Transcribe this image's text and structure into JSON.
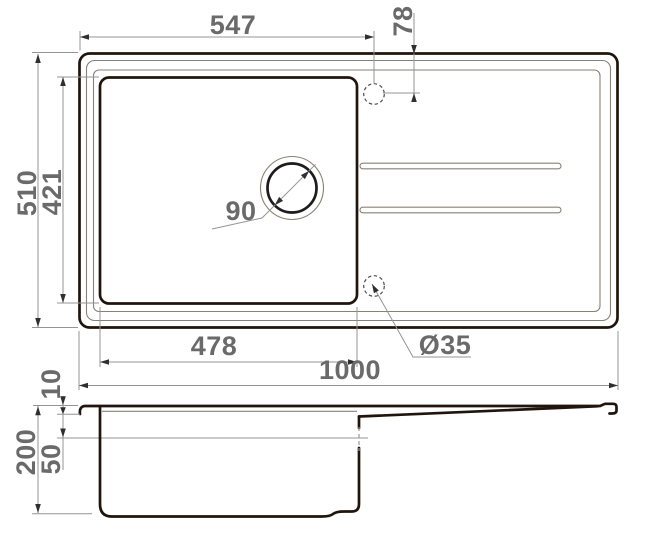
{
  "drawing": {
    "type": "technical-dimension-drawing",
    "subject": "kitchen sink with bowl and drainboard, plan view and section view",
    "units_implied": "mm",
    "dims": {
      "top_width": "547",
      "faucet_offset": "78",
      "overall_depth": "510",
      "bowl_depth": "421",
      "drain_diameter": "90",
      "bowl_width": "478",
      "faucet_hole_diameter": "Ø35",
      "overall_width": "1000",
      "rim_height": "10",
      "total_height": "200",
      "ledge_height": "50"
    },
    "colors": {
      "outline": "#20150d",
      "secondary_line": "#8a8075",
      "dimension_line": "#949494",
      "dimension_text": "#6a6a6a",
      "background": "#ffffff"
    }
  }
}
